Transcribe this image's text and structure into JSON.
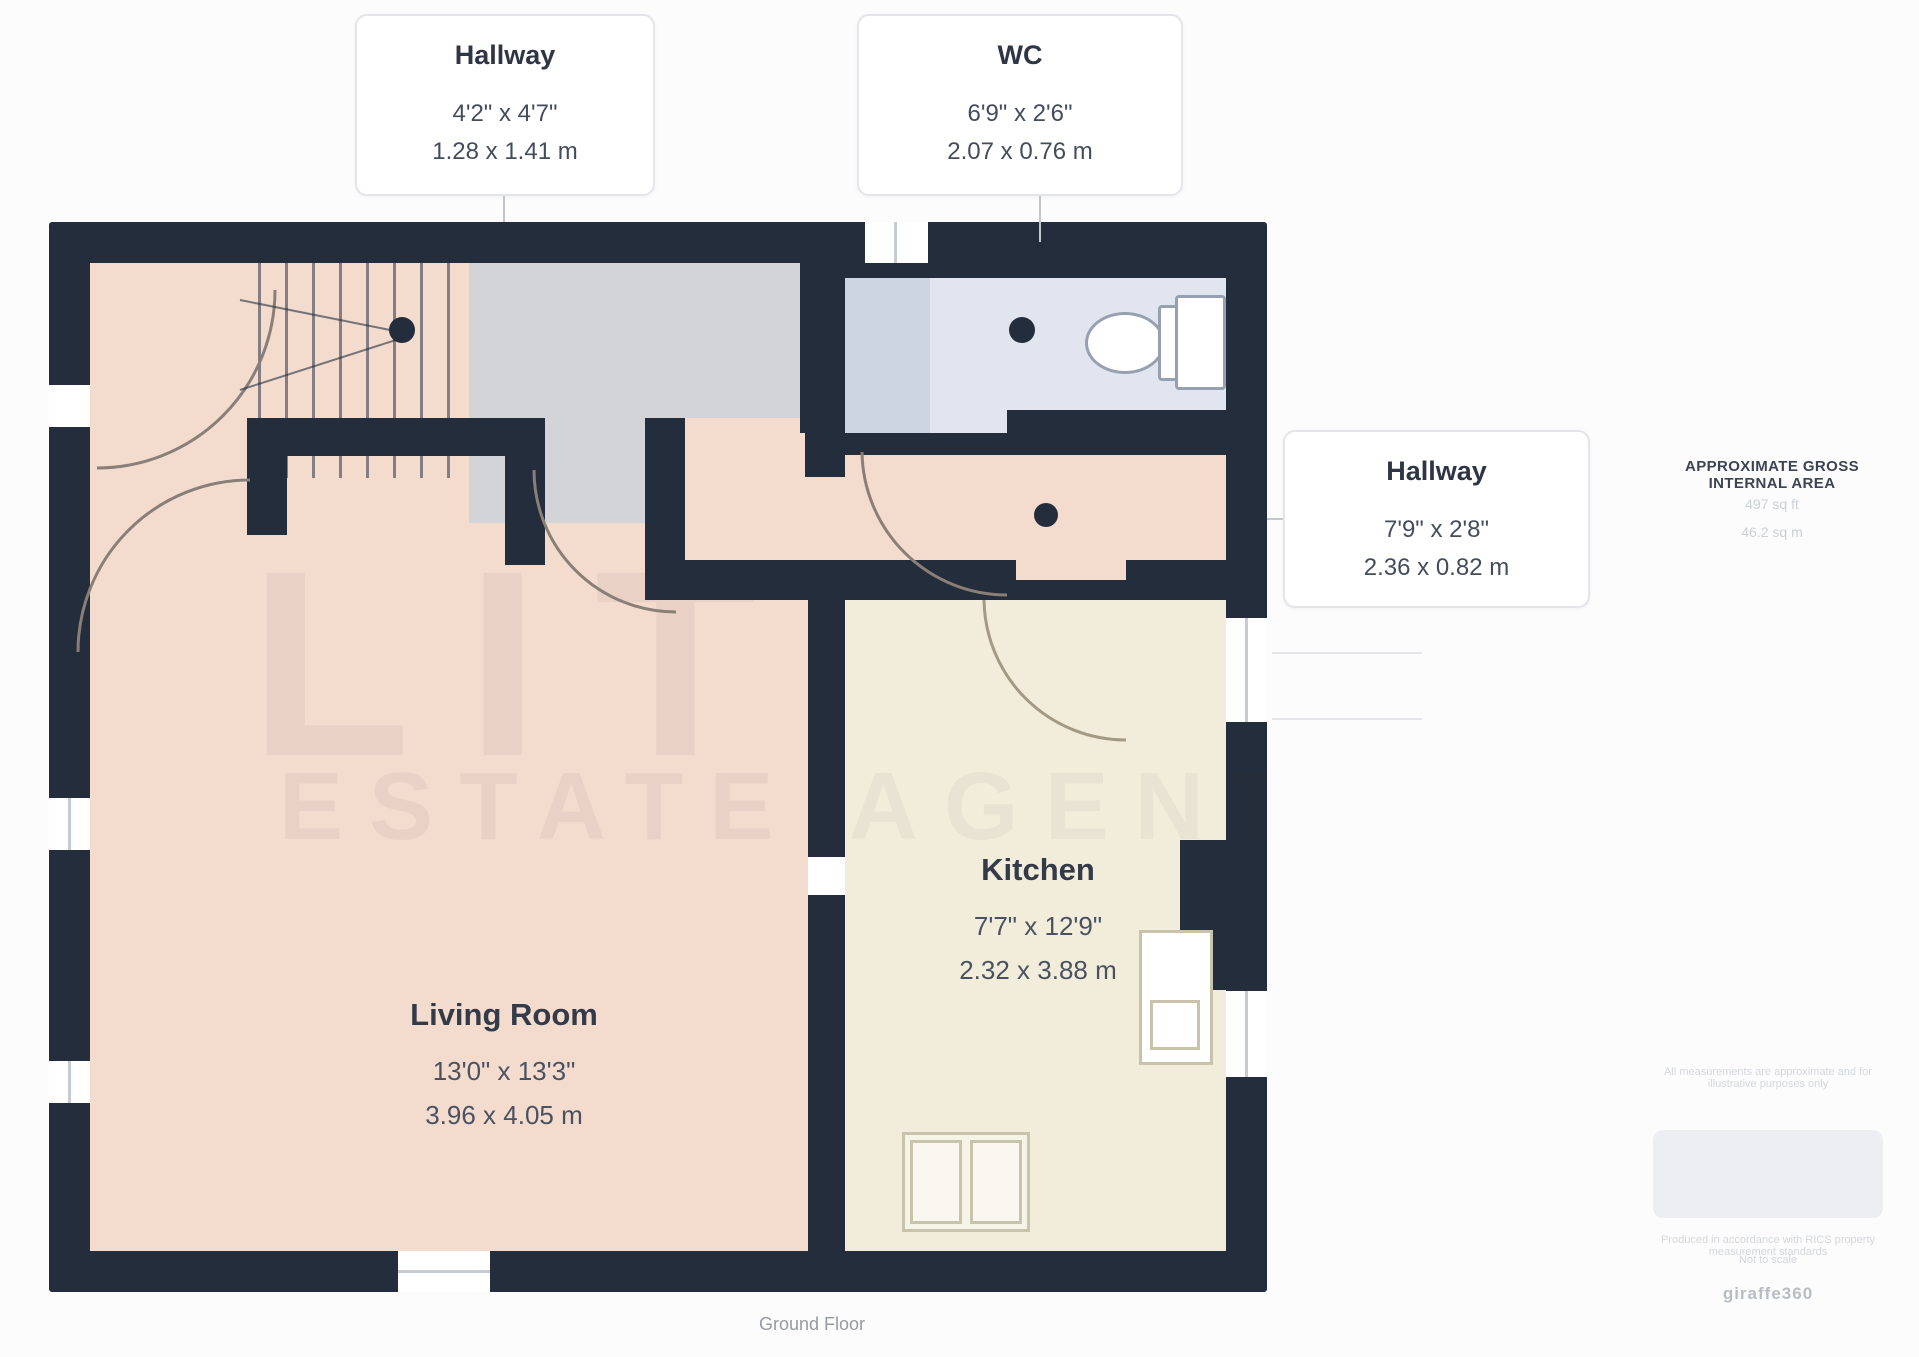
{
  "page": {
    "caption": "Ground Floor"
  },
  "labels": {
    "hallway_top": {
      "title": "Hallway",
      "imperial": "4'2\" x 4'7\"",
      "metric": "1.28 x 1.41 m"
    },
    "wc": {
      "title": "WC",
      "imperial": "6'9\" x 2'6\"",
      "metric": "2.07 x 0.76 m"
    },
    "hallway_right": {
      "title": "Hallway",
      "imperial": "7'9\" x 2'8\"",
      "metric": "2.36 x 0.82 m"
    },
    "living_room": {
      "title": "Living Room",
      "imperial": "13'0\" x 13'3\"",
      "metric": "3.96 x 4.05 m"
    },
    "kitchen": {
      "title": "Kitchen",
      "imperial": "7'7\" x 12'9\"",
      "metric": "2.32 x 3.88 m"
    }
  },
  "side_panel": {
    "area_title": "APPROXIMATE GROSS INTERNAL AREA",
    "area_imperial": "497 sq ft",
    "area_metric": "46.2 sq m"
  },
  "footer": {
    "note_line": "All measurements are approximate and for illustrative purposes only",
    "line_b": "Produced in accordance with RICS property measurement standards",
    "line_c": "Not to scale",
    "brand": "giraffe360"
  },
  "watermark": {
    "line1": "LIT",
    "line2": "ESTATE AGENTS"
  },
  "colors": {
    "wall": "#232d3b",
    "floor_pink": "#f3dbce",
    "floor_cream": "#f2eddb",
    "floor_gray": "#d3d4d7",
    "wc_blue": "#e0e5ef",
    "wc_blue_dark": "#cdd5e3",
    "label_text": "#2e3646"
  }
}
